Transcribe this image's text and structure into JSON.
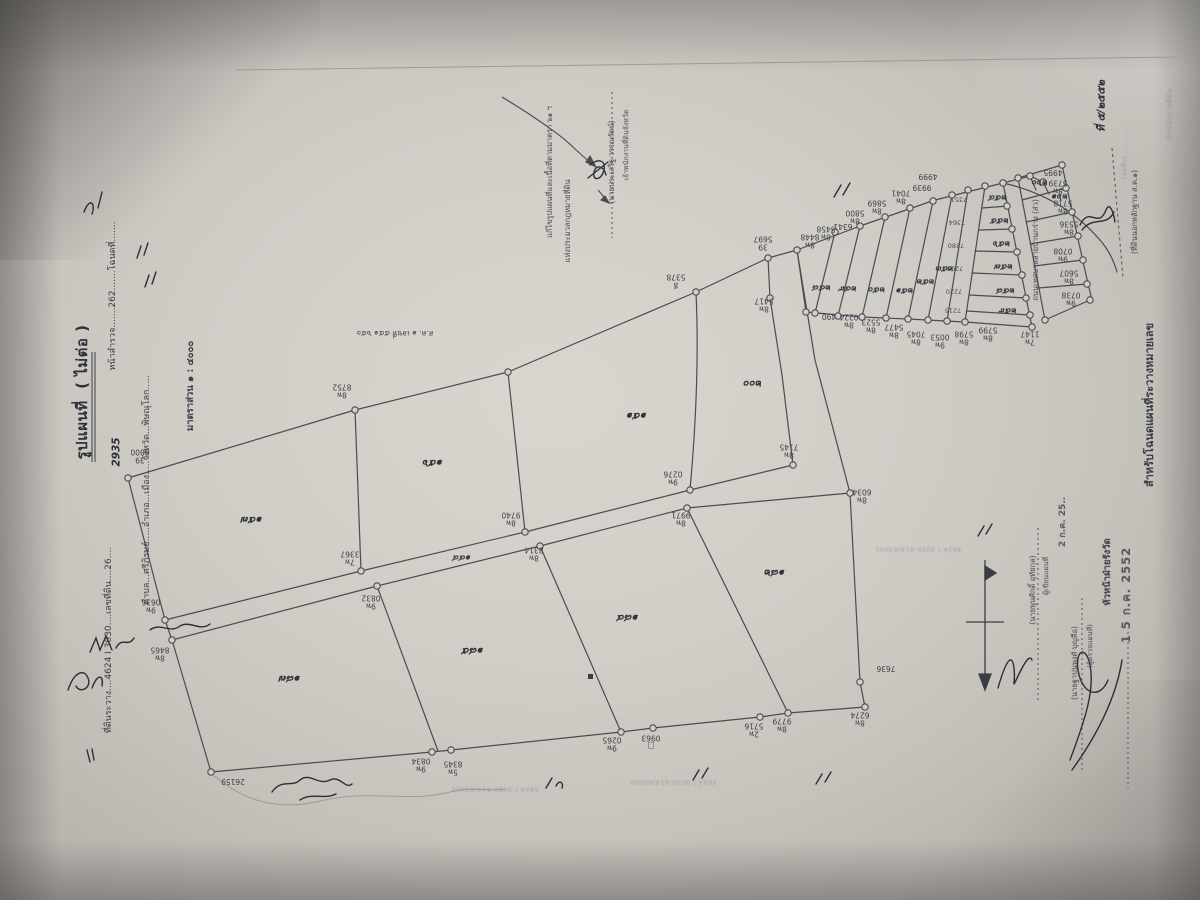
{
  "document": {
    "type_label": "รูปแผนที่  ( ไม่ต่อ )",
    "scale_label": "มาตราส่วน ๑ : ๔๐๐๐",
    "date_stamp_main": "1 5 ก.ค. 2552",
    "date_stamp_secondary": "2 ก.ค. 25..",
    "sheet_reference": "4624 I 3030-614/63001"
  },
  "labels": [
    {
      "n": "title",
      "x": 82,
      "y": 392,
      "r": "rm90",
      "c": "big",
      "t": "รูปแผนที่  ( ไม่ต่อ )"
    },
    {
      "n": "sheet-line",
      "x": 109,
      "y": 640,
      "r": "rm90",
      "c": "form",
      "t": "ที่ดินระวาง....4624 I 3030....เลขที่ดิน....26...."
    },
    {
      "n": "survey-line",
      "x": 113,
      "y": 296,
      "r": "rm90",
      "c": "form",
      "t": "หน้าสำรวจ.......262.......โฉนดที่......."
    },
    {
      "n": "survey-number-hand",
      "x": 117,
      "y": 452,
      "r": "rm90",
      "c": "hand2",
      "t": "2935"
    },
    {
      "n": "admin-line",
      "x": 147,
      "y": 490,
      "r": "rm90",
      "c": "form",
      "t": "ตำบล...ศรีภิรมย์.....อำเภอ...เมือง.....จังหวัด...พิษณุโลก....."
    },
    {
      "n": "scale-line",
      "x": 191,
      "y": 386,
      "r": "rm90",
      "c": "form2",
      "t": "มาตราส่วน ๑ : ๔๐๐๐"
    },
    {
      "n": "sor-kor-label",
      "x": 395,
      "y": 333,
      "r": "r180",
      "c": "small",
      "t": "ส.ค. ๑ เลขที่ ๕๕๑ ๖๕๐"
    },
    {
      "n": "amendment-line-1",
      "x": 550,
      "y": 172,
      "r": "rm90",
      "c": "small",
      "t": "แก้ไขรูปแผนที่และเนื้อที่ตามมาตรา ๖๑ ฯ"
    },
    {
      "n": "amendment-line-2",
      "x": 568,
      "y": 221,
      "r": "rm90",
      "c": "small",
      "t": "แห่งประมวลกฎหมายที่ดิน"
    },
    {
      "n": "amendment-signer",
      "x": 612,
      "y": 162,
      "r": "rm90",
      "c": "small",
      "t": "(นายประเสริฐ วรรณรัตน์)"
    },
    {
      "n": "amendment-role",
      "x": 627,
      "y": 145,
      "r": "rm90",
      "c": "tiny",
      "t": "เจ้าพนักงานที่ดินจังหวัด"
    },
    {
      "n": "road-right-label",
      "x": 1036,
      "y": 250,
      "r": "rm90",
      "c": "small",
      "t": "ถนนเทศบาลสายบ้านกร่าง (ส่ว)"
    },
    {
      "n": "dashed-note",
      "x": 1135,
      "y": 212,
      "r": "rm90",
      "c": "small",
      "t": "(ที่ดินนอกหลักฐาน ส.ค.๑)"
    },
    {
      "n": "right-edge-text",
      "x": 1150,
      "y": 405,
      "r": "rm90",
      "c": "big2",
      "t": "สำหรับโฉนดแผนที่ระวางหมายเลข"
    },
    {
      "n": "corner-note-hand",
      "x": 1102,
      "y": 106,
      "r": "rm90",
      "c": "hand2",
      "t": "ที่ ๕/๒๕๕๒"
    },
    {
      "n": "sign1-name",
      "x": 1033,
      "y": 590,
      "r": "rm90",
      "c": "small",
      "t": "(นายพูนศักดิ์ อุทัยกุล)"
    },
    {
      "n": "sign1-role",
      "x": 1047,
      "y": 576,
      "r": "rm90",
      "c": "tiny",
      "t": "ผู้เขียนแผนที่"
    },
    {
      "n": "sign2-name",
      "x": 1075,
      "y": 663,
      "r": "rm90",
      "c": "small",
      "t": "(นายฐาปนพงศ์ บุญลือ)"
    },
    {
      "n": "sign2-role",
      "x": 1091,
      "y": 646,
      "r": "rm90",
      "c": "tiny",
      "t": "(ผู้ตรวจแผนที่)"
    },
    {
      "n": "sign3-role",
      "x": 1108,
      "y": 572,
      "r": "rm90",
      "c": "form2",
      "t": "หัวหน้าฝ่ายรังวัด"
    },
    {
      "n": "date-stamp-1",
      "x": 1063,
      "y": 522,
      "r": "rm90",
      "c": "stamp",
      "t": "2 ก.ค. 25.."
    },
    {
      "n": "date-stamp-2",
      "x": 1126,
      "y": 595,
      "r": "rm90",
      "c": "stamp2",
      "t": "1 5 ก.ค. 2552"
    },
    {
      "n": "ref-stamp-1",
      "x": 918,
      "y": 549,
      "r": "r180",
      "c": "ghost",
      "t": "4624 I 3030-614/63001"
    },
    {
      "n": "ref-stamp-2",
      "x": 495,
      "y": 789,
      "r": "r180",
      "c": "ghost",
      "t": "4624 I 3030-614/63001"
    },
    {
      "n": "ref-stamp-3",
      "x": 673,
      "y": 782,
      "r": "r180",
      "c": "ghost",
      "t": "4624 I 3030-614/63001"
    },
    {
      "n": "corner-faint-1",
      "x": 1125,
      "y": 152,
      "r": "rm90",
      "c": "ghost",
      "t": "(ลงชื่อ)............"
    },
    {
      "n": "corner-faint-2",
      "x": 1170,
      "y": 115,
      "r": "rm90",
      "c": "ghost",
      "t": "เจ้าพนักงานที่ดิน"
    },
    {
      "n": "road-name-hand",
      "x": 462,
      "y": 557,
      "r": "r180",
      "c": "hand-sm",
      "t": "๑๔๔"
    },
    {
      "n": "parcel-no",
      "x": 252,
      "y": 519,
      "r": "r180",
      "c": "hand",
      "t": "๑๕๗"
    },
    {
      "n": "parcel-no",
      "x": 433,
      "y": 462,
      "r": "r180",
      "c": "hand",
      "t": "๑๕๖"
    },
    {
      "n": "parcel-no",
      "x": 637,
      "y": 415,
      "r": "r180",
      "c": "hand",
      "t": "๑๕๑"
    },
    {
      "n": "parcel-no",
      "x": 753,
      "y": 383,
      "r": "r180",
      "c": "hand",
      "t": "๒๐๐"
    },
    {
      "n": "parcel-no",
      "x": 290,
      "y": 678,
      "r": "r180",
      "c": "hand",
      "t": "๑๘๗"
    },
    {
      "n": "parcel-no",
      "x": 473,
      "y": 650,
      "r": "r180",
      "c": "hand",
      "t": "๑๘๕"
    },
    {
      "n": "parcel-no",
      "x": 628,
      "y": 617,
      "r": "r180",
      "c": "hand",
      "t": "๑๘๔"
    },
    {
      "n": "parcel-no",
      "x": 775,
      "y": 572,
      "r": "r180",
      "c": "hand",
      "t": "๑๘๒"
    },
    {
      "n": "strip-no",
      "x": 822,
      "y": 287,
      "r": "r180",
      "c": "hand-sm",
      "t": "๒๔๘"
    },
    {
      "n": "strip-no",
      "x": 848,
      "y": 288,
      "r": "r180",
      "c": "hand-sm",
      "t": "๒๔๙"
    },
    {
      "n": "strip-no",
      "x": 877,
      "y": 289,
      "r": "r180",
      "c": "hand-sm",
      "t": "๒๕๐"
    },
    {
      "n": "strip-no",
      "x": 905,
      "y": 290,
      "r": "r180",
      "c": "hand-sm",
      "t": "๒๕๑"
    },
    {
      "n": "strip-no",
      "x": 926,
      "y": 281,
      "r": "r180",
      "c": "hand-sm",
      "t": "๒๕๒"
    },
    {
      "n": "strip-no",
      "x": 945,
      "y": 268,
      "r": "r180",
      "c": "hand-sm",
      "t": "๒๕๓"
    },
    {
      "n": "strip-no",
      "x": 998,
      "y": 197,
      "r": "r180",
      "c": "hand-sm",
      "t": "๒๕๔"
    },
    {
      "n": "strip-no",
      "x": 1000,
      "y": 220,
      "r": "r180",
      "c": "hand-sm",
      "t": "๒๕๕"
    },
    {
      "n": "strip-no",
      "x": 1002,
      "y": 243,
      "r": "r180",
      "c": "hand-sm",
      "t": "๒๕๖"
    },
    {
      "n": "strip-no",
      "x": 1004,
      "y": 266,
      "r": "r180",
      "c": "hand-sm",
      "t": "๒๕๗"
    },
    {
      "n": "strip-no",
      "x": 1006,
      "y": 290,
      "r": "r180",
      "c": "hand-sm",
      "t": "๒๕๘"
    },
    {
      "n": "strip-no",
      "x": 1008,
      "y": 310,
      "r": "r180",
      "c": "hand-sm",
      "t": "๒๕๙"
    },
    {
      "n": "strip-no",
      "x": 1040,
      "y": 182,
      "r": "r180",
      "c": "hand-sm",
      "t": "๒๖๐"
    },
    {
      "n": "strip-no",
      "x": 1060,
      "y": 196,
      "r": "r180",
      "c": "hand-sm",
      "t": "๒๖๑"
    },
    {
      "n": "vertex-label",
      "x": 140,
      "y": 456,
      "r": "r180",
      "c": "vtx",
      "t": "39\n8800"
    },
    {
      "n": "vertex-label",
      "x": 342,
      "y": 391,
      "r": "r180",
      "c": "vtx",
      "t": "8พ\n8752"
    },
    {
      "n": "vertex-label",
      "x": 676,
      "y": 281,
      "r": "r180",
      "c": "vtx",
      "t": "ลี\n5378"
    },
    {
      "n": "vertex-label",
      "x": 763,
      "y": 243,
      "r": "r180",
      "c": "vtx",
      "t": "39\n5697"
    },
    {
      "n": "vertex-label",
      "x": 764,
      "y": 305,
      "r": "r180",
      "c": "vtx",
      "t": "8พ\n5417"
    },
    {
      "n": "vertex-label",
      "x": 350,
      "y": 558,
      "r": "r180",
      "c": "vtx",
      "t": "7พ\n3367"
    },
    {
      "n": "vertex-label",
      "x": 511,
      "y": 519,
      "r": "r180",
      "c": "vtx",
      "t": "8พ\n9740"
    },
    {
      "n": "vertex-label",
      "x": 673,
      "y": 478,
      "r": "r180",
      "c": "vtx",
      "t": "9พ\n0276"
    },
    {
      "n": "vertex-label",
      "x": 789,
      "y": 451,
      "r": "r180",
      "c": "vtx",
      "t": "8พ\n7145"
    },
    {
      "n": "vertex-label",
      "x": 862,
      "y": 496,
      "r": "r180",
      "c": "vtx",
      "t": "8พ\n6034"
    },
    {
      "n": "vertex-label",
      "x": 371,
      "y": 602,
      "r": "r180",
      "c": "vtx",
      "t": "9พ\n0832"
    },
    {
      "n": "vertex-label",
      "x": 534,
      "y": 554,
      "r": "r180",
      "c": "vtx",
      "t": "8พ\n8314"
    },
    {
      "n": "vertex-label",
      "x": 681,
      "y": 519,
      "r": "r180",
      "c": "vtx",
      "t": "8พ\n9971"
    },
    {
      "n": "vertex-label",
      "x": 151,
      "y": 606,
      "r": "r180",
      "c": "vtx",
      "t": "9พ\n0636"
    },
    {
      "n": "vertex-label",
      "x": 160,
      "y": 654,
      "r": "r180",
      "c": "vtx",
      "t": "8พ\n8465"
    },
    {
      "n": "vertex-label",
      "x": 233,
      "y": 781,
      "r": "r180",
      "c": "vtx",
      "t": "26159"
    },
    {
      "n": "vertex-label",
      "x": 421,
      "y": 765,
      "r": "r180",
      "c": "vtx",
      "t": "9พ\n0834"
    },
    {
      "n": "vertex-label",
      "x": 453,
      "y": 768,
      "r": "r180",
      "c": "vtx",
      "t": "5พ\n8345"
    },
    {
      "n": "vertex-label",
      "x": 612,
      "y": 744,
      "r": "r180",
      "c": "vtx",
      "t": "9พ\n0265"
    },
    {
      "n": "vertex-label",
      "x": 651,
      "y": 742,
      "r": "r180",
      "c": "vtx",
      "t": "□\n0963"
    },
    {
      "n": "vertex-label",
      "x": 754,
      "y": 730,
      "r": "r180",
      "c": "vtx",
      "t": "2พ\n5716"
    },
    {
      "n": "vertex-label",
      "x": 782,
      "y": 725,
      "r": "r180",
      "c": "vtx",
      "t": "8พ\n9779"
    },
    {
      "n": "vertex-label",
      "x": 860,
      "y": 719,
      "r": "r180",
      "c": "vtx",
      "t": "8พ\n6274"
    },
    {
      "n": "vertex-label",
      "x": 886,
      "y": 668,
      "r": "r180",
      "c": "vtx",
      "t": "7636"
    },
    {
      "n": "vertex-label",
      "x": 810,
      "y": 241,
      "r": "r180",
      "c": "vtx",
      "t": "8พ\n8448"
    },
    {
      "n": "vertex-label",
      "x": 826,
      "y": 233,
      "r": "r180",
      "c": "vtx",
      "t": "8พ\n5458"
    },
    {
      "n": "vertex-label",
      "x": 843,
      "y": 226,
      "r": "r180",
      "c": "vtx",
      "t": "6341"
    },
    {
      "n": "vertex-label",
      "x": 855,
      "y": 217,
      "r": "r180",
      "c": "vtx",
      "t": "8พ\n5800"
    },
    {
      "n": "vertex-label",
      "x": 877,
      "y": 207,
      "r": "r180",
      "c": "vtx",
      "t": "8พ\n5869"
    },
    {
      "n": "vertex-label",
      "x": 901,
      "y": 197,
      "r": "r180",
      "c": "vtx",
      "t": "8พ\n7041"
    },
    {
      "n": "vertex-label",
      "x": 922,
      "y": 187,
      "r": "r180",
      "c": "vtx",
      "t": "9939"
    },
    {
      "n": "vertex-label",
      "x": 928,
      "y": 176,
      "r": "r180",
      "c": "vtx",
      "t": "4999"
    },
    {
      "n": "vertex-label",
      "x": 1030,
      "y": 338,
      "r": "r180",
      "c": "vtx",
      "t": "7พ\n1147"
    },
    {
      "n": "vertex-label",
      "x": 988,
      "y": 334,
      "r": "r180",
      "c": "vtx",
      "t": "8พ\n5799"
    },
    {
      "n": "vertex-label",
      "x": 964,
      "y": 338,
      "r": "r180",
      "c": "vtx",
      "t": "8พ\n5798"
    },
    {
      "n": "vertex-label",
      "x": 940,
      "y": 341,
      "r": "r180",
      "c": "vtx",
      "t": "9พ\n0053"
    },
    {
      "n": "vertex-label",
      "x": 916,
      "y": 338,
      "r": "r180",
      "c": "vtx",
      "t": "8พ\n7045"
    },
    {
      "n": "vertex-label",
      "x": 894,
      "y": 331,
      "r": "r180",
      "c": "vtx",
      "t": "8พ\n5477"
    },
    {
      "n": "vertex-label",
      "x": 871,
      "y": 326,
      "r": "r180",
      "c": "vtx",
      "t": "8พ\n5523"
    },
    {
      "n": "vertex-label",
      "x": 849,
      "y": 321,
      "r": "r180",
      "c": "vtx",
      "t": "8พ\n0224"
    },
    {
      "n": "vertex-label",
      "x": 829,
      "y": 316,
      "r": "r180",
      "c": "vtx",
      "t": "490"
    },
    {
      "n": "vertex-label",
      "x": 1053,
      "y": 172,
      "r": "r180",
      "c": "vtx",
      "t": "4995"
    },
    {
      "n": "vertex-label",
      "x": 1058,
      "y": 187,
      "r": "r180",
      "c": "vtx",
      "t": "8พ\n5739"
    },
    {
      "n": "vertex-label",
      "x": 1063,
      "y": 207,
      "r": "r180",
      "c": "vtx",
      "t": "8พ\n5718"
    },
    {
      "n": "vertex-label",
      "x": 1069,
      "y": 228,
      "r": "r180",
      "c": "vtx",
      "t": "8พ\n5536"
    },
    {
      "n": "vertex-label",
      "x": 1063,
      "y": 255,
      "r": "r180",
      "c": "vtx",
      "t": "9พ\n0708"
    },
    {
      "n": "vertex-label",
      "x": 1069,
      "y": 277,
      "r": "r180",
      "c": "vtx",
      "t": "8พ\n5607"
    },
    {
      "n": "vertex-label",
      "x": 1071,
      "y": 299,
      "r": "r180",
      "c": "vtx",
      "t": "9พ\n0738"
    },
    {
      "n": "vertex-label",
      "x": 959,
      "y": 199,
      "r": "r180",
      "c": "vtx2",
      "t": "7351"
    },
    {
      "n": "vertex-label",
      "x": 957,
      "y": 222,
      "r": "r180",
      "c": "vtx2",
      "t": "7364"
    },
    {
      "n": "vertex-label",
      "x": 956,
      "y": 245,
      "r": "r180",
      "c": "vtx2",
      "t": "7280"
    },
    {
      "n": "vertex-label",
      "x": 955,
      "y": 268,
      "r": "r180",
      "c": "vtx2",
      "t": "7203"
    },
    {
      "n": "vertex-label",
      "x": 954,
      "y": 291,
      "r": "r180",
      "c": "vtx2",
      "t": "7220"
    },
    {
      "n": "vertex-label",
      "x": 953,
      "y": 310,
      "r": "r180",
      "c": "vtx2",
      "t": "7215"
    }
  ],
  "vertices": [
    [
      128,
      478
    ],
    [
      355,
      410
    ],
    [
      508,
      372
    ],
    [
      696,
      292
    ],
    [
      768,
      258
    ],
    [
      770,
      298
    ],
    [
      793,
      465
    ],
    [
      361,
      571
    ],
    [
      525,
      532
    ],
    [
      690,
      490
    ],
    [
      377,
      586
    ],
    [
      540,
      546
    ],
    [
      687,
      508
    ],
    [
      850,
      493
    ],
    [
      165,
      620
    ],
    [
      172,
      640
    ],
    [
      211,
      772
    ],
    [
      432,
      752
    ],
    [
      451,
      750
    ],
    [
      621,
      732
    ],
    [
      653,
      728
    ],
    [
      760,
      717
    ],
    [
      788,
      713
    ],
    [
      865,
      707
    ],
    [
      860,
      682
    ],
    [
      797,
      250
    ],
    [
      835,
      232
    ],
    [
      860,
      226
    ],
    [
      885,
      217
    ],
    [
      910,
      208
    ],
    [
      933,
      201
    ],
    [
      952,
      195
    ],
    [
      968,
      190
    ],
    [
      985,
      186
    ],
    [
      1003,
      183
    ],
    [
      806,
      312
    ],
    [
      815,
      313
    ],
    [
      838,
      316
    ],
    [
      862,
      317
    ],
    [
      886,
      318
    ],
    [
      908,
      319
    ],
    [
      928,
      320
    ],
    [
      947,
      321
    ],
    [
      965,
      322
    ],
    [
      1032,
      327
    ],
    [
      1007,
      206
    ],
    [
      1012,
      229
    ],
    [
      1017,
      252
    ],
    [
      1022,
      275
    ],
    [
      1026,
      298
    ],
    [
      1030,
      315
    ],
    [
      1018,
      178
    ],
    [
      1045,
      320
    ],
    [
      1062,
      165
    ],
    [
      1066,
      188
    ],
    [
      1072,
      212
    ],
    [
      1078,
      236
    ],
    [
      1083,
      260
    ],
    [
      1087,
      284
    ],
    [
      1090,
      300
    ],
    [
      1030,
      176
    ],
    [
      1043,
      182
    ]
  ]
}
